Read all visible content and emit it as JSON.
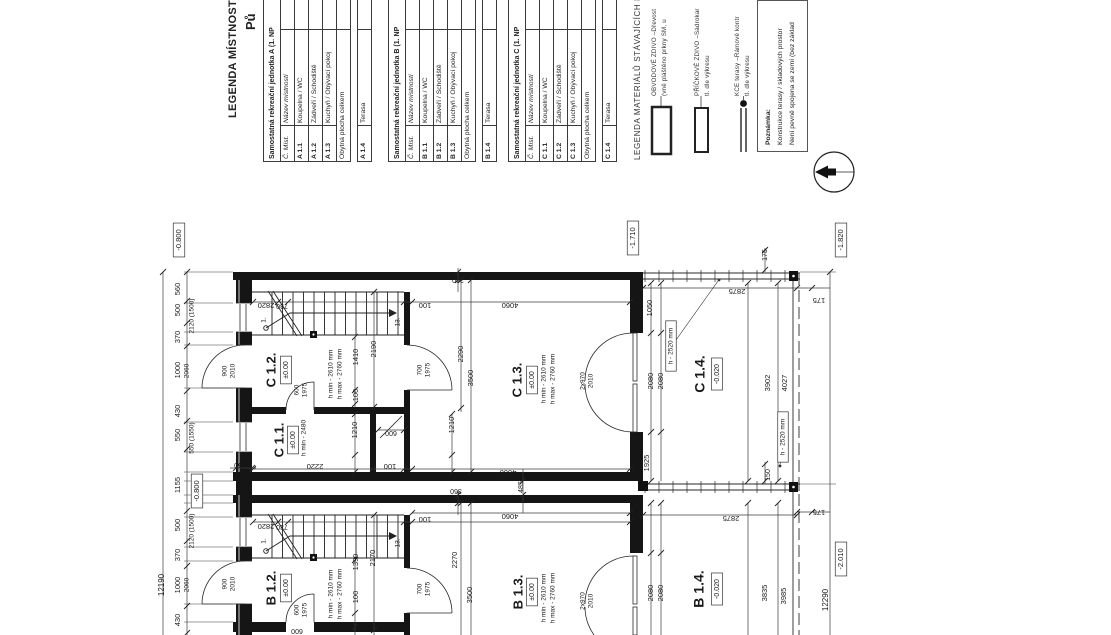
{
  "sheet": {
    "partial_title": "Pů",
    "rooms_legend_title": "LEGENDA MÍSTNOSTÍ:",
    "tables": [
      {
        "header": "Samostatná rekreační jednotka A (1. NP",
        "col1": "Č. Míst.",
        "col2": "Název místností",
        "rows": [
          [
            "A 1.1",
            "Koupelna / WC"
          ],
          [
            "A 1.2",
            "Zádveří / Schodiště"
          ],
          [
            "A 1.3",
            "Kuchyň / Obývací pokoj"
          ]
        ],
        "total_label": "Obytná plocha celkem",
        "extra_row": [
          "A 1.4",
          "Terasa"
        ]
      },
      {
        "header": "Samostatná rekreační jednotka B (1. NP",
        "col1": "Č. Míst.",
        "col2": "Název místností",
        "rows": [
          [
            "B 1.1",
            "Koupelna / WC"
          ],
          [
            "B 1.2",
            "Zádveří / Schodiště"
          ],
          [
            "B 1.3",
            "Kuchyň / Obývací pokoj"
          ]
        ],
        "total_label": "Obytná plocha celkem",
        "extra_row": [
          "B 1.4",
          "Terasa"
        ]
      },
      {
        "header": "Samostatná rekreační jednotka C (1. NP",
        "col1": "Č. Míst.",
        "col2": "Název místností",
        "rows": [
          [
            "C 1.1",
            "Koupelna / WC"
          ],
          [
            "C 1.2",
            "Zádveří / Schodiště"
          ],
          [
            "C 1.3",
            "Kuchyň / Obývací pokoj"
          ]
        ],
        "total_label": "Obytná plocha celkem",
        "extra_row": [
          "C 1.4",
          "Terasa"
        ]
      }
    ],
    "materials_legend": {
      "title": "LEGENDA MATERIÁLŮ STÁVAJÍCÍCH KONSTR",
      "items": [
        {
          "line1": "OBVODOVÉ ZDIVO –Dřevost",
          "line2": "(vně pláštěno prkny SM, u"
        },
        {
          "line1": "PŘÍČKOVÉ ZDIVO –Sádrokar",
          "line2": "tl. dle výkresu"
        },
        {
          "line1": "KCE terasy –Rámově kontr",
          "line2": "tl. dle výkresu"
        }
      ]
    },
    "note": {
      "title": "Poznámka:",
      "line1": "Konstrukce terasy / skladových prostor",
      "line2": "Není pevně spojena se zemí (bez základ"
    },
    "line_color": "#1a1a1a"
  },
  "plan": {
    "labels": [
      {
        "t": "-0.800",
        "x": 179,
        "y": 240,
        "r": -90,
        "s": 7.5,
        "box": 1
      },
      {
        "t": "-0.800",
        "x": 197,
        "y": 491,
        "r": -90,
        "s": 7.5,
        "box": 1
      },
      {
        "t": "-1.710",
        "x": 633,
        "y": 238,
        "r": -90,
        "s": 7.5,
        "box": 1
      },
      {
        "t": "-1.820",
        "x": 841,
        "y": 240,
        "r": -90,
        "s": 7.5,
        "box": 1
      },
      {
        "t": "-2.010",
        "x": 841,
        "y": 559,
        "r": -90,
        "s": 7.5,
        "box": 1
      },
      {
        "t": "±0.00",
        "x": 286,
        "y": 370,
        "r": -90,
        "s": 7,
        "box": 1
      },
      {
        "t": "±0.00",
        "x": 293,
        "y": 440,
        "r": -90,
        "s": 7,
        "box": 1
      },
      {
        "t": "±0.00",
        "x": 532,
        "y": 380,
        "r": -90,
        "s": 7,
        "box": 1
      },
      {
        "t": "±0.00",
        "x": 286,
        "y": 588,
        "r": -90,
        "s": 7,
        "box": 1
      },
      {
        "t": "±0.00",
        "x": 532,
        "y": 592,
        "r": -90,
        "s": 7,
        "box": 1
      },
      {
        "t": "-0.020",
        "x": 717,
        "y": 374,
        "r": -90,
        "s": 7,
        "box": 1
      },
      {
        "t": "-0.020",
        "x": 717,
        "y": 589,
        "r": -90,
        "s": 7,
        "box": 1
      },
      {
        "t": "h - 2520 mm",
        "x": 671,
        "y": 346,
        "r": -90,
        "s": 6.5,
        "box": 1
      },
      {
        "t": "h - 2520 mm",
        "x": 783,
        "y": 437,
        "r": -90,
        "s": 6.5,
        "box": 1
      },
      {
        "t": "C 1.2.",
        "x": 272,
        "y": 370,
        "r": -90,
        "s": 13,
        "b": 1
      },
      {
        "t": "C 1.1.",
        "x": 280,
        "y": 440,
        "r": -90,
        "s": 13,
        "b": 1
      },
      {
        "t": "C 1.3.",
        "x": 518,
        "y": 380,
        "r": -90,
        "s": 13,
        "b": 1
      },
      {
        "t": "C 1.4.",
        "x": 701,
        "y": 374,
        "r": -90,
        "s": 14,
        "b": 1
      },
      {
        "t": "B 1.2.",
        "x": 272,
        "y": 588,
        "r": -90,
        "s": 13,
        "b": 1
      },
      {
        "t": "B 1.3.",
        "x": 519,
        "y": 592,
        "r": -90,
        "s": 13,
        "b": 1
      },
      {
        "t": "B 1.4.",
        "x": 700,
        "y": 589,
        "r": -90,
        "s": 14,
        "b": 1
      },
      {
        "t": "h min - 2480",
        "x": 304,
        "y": 438,
        "r": -90,
        "s": 6.5
      },
      {
        "t": "h min - 2610 mm",
        "x": 331,
        "y": 374,
        "r": -90,
        "s": 6.5
      },
      {
        "t": "h max - 2760 mm",
        "x": 340,
        "y": 374,
        "r": -90,
        "s": 6.5
      },
      {
        "t": "h min - 2610 mm",
        "x": 544,
        "y": 379,
        "r": -90,
        "s": 6.5
      },
      {
        "t": "h max - 2760 mm",
        "x": 553,
        "y": 379,
        "r": -90,
        "s": 6.5
      },
      {
        "t": "h min - 2610 mm",
        "x": 331,
        "y": 594,
        "r": -90,
        "s": 6.5
      },
      {
        "t": "h max - 2760 mm",
        "x": 340,
        "y": 594,
        "r": -90,
        "s": 6.5
      },
      {
        "t": "h min - 2610 mm",
        "x": 544,
        "y": 598,
        "r": -90,
        "s": 6.5
      },
      {
        "t": "h max - 2760 mm",
        "x": 553,
        "y": 598,
        "r": -90,
        "s": 6.5
      },
      {
        "t": "2820",
        "x": 266,
        "y": 305,
        "r": 180,
        "s": 7.5
      },
      {
        "t": "730",
        "x": 282,
        "y": 306,
        "r": 180,
        "s": 7
      },
      {
        "t": "100",
        "x": 425,
        "y": 305,
        "r": 180,
        "s": 7.5
      },
      {
        "t": "4060",
        "x": 510,
        "y": 305,
        "r": 180,
        "s": 7.5
      },
      {
        "t": "360",
        "x": 458,
        "y": 280,
        "r": 180,
        "s": 7
      },
      {
        "t": "2220",
        "x": 315,
        "y": 466,
        "r": 180,
        "s": 7.5
      },
      {
        "t": "100",
        "x": 390,
        "y": 466,
        "r": 180,
        "s": 7.5
      },
      {
        "t": "360",
        "x": 240,
        "y": 465,
        "r": 180,
        "s": 7
      },
      {
        "t": "600",
        "x": 391,
        "y": 433,
        "r": 180,
        "s": 7
      },
      {
        "t": "4660",
        "x": 508,
        "y": 472,
        "r": 180,
        "s": 7.5
      },
      {
        "t": "4060",
        "x": 510,
        "y": 516,
        "r": 180,
        "s": 7.5
      },
      {
        "t": "2820",
        "x": 266,
        "y": 526,
        "r": 180,
        "s": 7.5
      },
      {
        "t": "730",
        "x": 282,
        "y": 527,
        "r": 180,
        "s": 7
      },
      {
        "t": "100",
        "x": 425,
        "y": 519,
        "r": 180,
        "s": 7.5
      },
      {
        "t": "360",
        "x": 456,
        "y": 491,
        "r": 180,
        "s": 7
      },
      {
        "t": "2875",
        "x": 737,
        "y": 291,
        "r": 180,
        "s": 7.5
      },
      {
        "t": "2875",
        "x": 731,
        "y": 518,
        "r": 180,
        "s": 7.5
      },
      {
        "t": "175",
        "x": 819,
        "y": 300,
        "r": 180,
        "s": 7.5
      },
      {
        "t": "175",
        "x": 819,
        "y": 512,
        "r": 180,
        "s": 7.5
      },
      {
        "t": "600",
        "x": 297,
        "y": 631,
        "r": 180,
        "s": 7
      },
      {
        "t": "560",
        "x": 178,
        "y": 289,
        "r": -90,
        "s": 7.5
      },
      {
        "t": "500",
        "x": 178,
        "y": 310,
        "r": -90,
        "s": 7.5
      },
      {
        "t": "370",
        "x": 178,
        "y": 337,
        "r": -90,
        "s": 7.5
      },
      {
        "t": "1000",
        "x": 178,
        "y": 370,
        "r": -90,
        "s": 7.5
      },
      {
        "t": "430",
        "x": 178,
        "y": 411,
        "r": -90,
        "s": 7.5
      },
      {
        "t": "550",
        "x": 178,
        "y": 435,
        "r": -90,
        "s": 7.5
      },
      {
        "t": "1155",
        "x": 178,
        "y": 485,
        "r": -90,
        "s": 7.5
      },
      {
        "t": "500",
        "x": 178,
        "y": 525,
        "r": -90,
        "s": 7.5
      },
      {
        "t": "370",
        "x": 178,
        "y": 555,
        "r": -90,
        "s": 7.5
      },
      {
        "t": "1000",
        "x": 178,
        "y": 585,
        "r": -90,
        "s": 7.5
      },
      {
        "t": "430",
        "x": 178,
        "y": 620,
        "r": -90,
        "s": 7.5
      },
      {
        "t": "12190",
        "x": 162,
        "y": 585,
        "r": -90,
        "s": 8
      },
      {
        "t": "12290",
        "x": 826,
        "y": 600,
        "r": -90,
        "s": 8
      },
      {
        "t": "2120 (1500)",
        "x": 192,
        "y": 316,
        "r": -90,
        "s": 6.5
      },
      {
        "t": "550 (1550)",
        "x": 192,
        "y": 438,
        "r": -90,
        "s": 6.5
      },
      {
        "t": "2120 (1500)",
        "x": 192,
        "y": 531,
        "r": -90,
        "s": 6.5
      },
      {
        "t": "2060",
        "x": 187,
        "y": 371,
        "r": -90,
        "s": 6.5
      },
      {
        "t": "2060",
        "x": 187,
        "y": 585,
        "r": -90,
        "s": 6.5
      },
      {
        "t": "2190",
        "x": 374,
        "y": 349,
        "r": -90,
        "s": 7.5
      },
      {
        "t": "1410",
        "x": 356,
        "y": 357,
        "r": -90,
        "s": 7.5
      },
      {
        "t": "100",
        "x": 356,
        "y": 395,
        "r": -90,
        "s": 7.5
      },
      {
        "t": "2290",
        "x": 461,
        "y": 354,
        "r": -90,
        "s": 7.5
      },
      {
        "t": "3500",
        "x": 471,
        "y": 378,
        "r": -90,
        "s": 7.5
      },
      {
        "t": "1210",
        "x": 355,
        "y": 430,
        "r": -90,
        "s": 7.5
      },
      {
        "t": "1210",
        "x": 452,
        "y": 425,
        "r": -90,
        "s": 7.5
      },
      {
        "t": "2170",
        "x": 373,
        "y": 558,
        "r": -90,
        "s": 7.5
      },
      {
        "t": "1390",
        "x": 356,
        "y": 562,
        "r": -90,
        "s": 7.5
      },
      {
        "t": "100",
        "x": 356,
        "y": 597,
        "r": -90,
        "s": 7.5
      },
      {
        "t": "2270",
        "x": 455,
        "y": 560,
        "r": -90,
        "s": 7.5
      },
      {
        "t": "3500",
        "x": 470,
        "y": 595,
        "r": -90,
        "s": 7.5
      },
      {
        "t": "1925",
        "x": 647,
        "y": 463,
        "r": -90,
        "s": 7.5
      },
      {
        "t": "1050",
        "x": 650,
        "y": 308,
        "r": -90,
        "s": 7.5
      },
      {
        "t": "2080",
        "x": 651,
        "y": 381,
        "r": -90,
        "s": 7.5
      },
      {
        "t": "2080",
        "x": 661,
        "y": 381,
        "r": -90,
        "s": 7.5
      },
      {
        "t": "2080",
        "x": 651,
        "y": 593,
        "r": -90,
        "s": 7.5
      },
      {
        "t": "2080",
        "x": 661,
        "y": 593,
        "r": -90,
        "s": 7.5
      },
      {
        "t": "3902",
        "x": 768,
        "y": 383,
        "r": -90,
        "s": 7.5
      },
      {
        "t": "4027",
        "x": 785,
        "y": 383,
        "r": -90,
        "s": 7.5
      },
      {
        "t": "3835",
        "x": 765,
        "y": 593,
        "r": -90,
        "s": 7.5
      },
      {
        "t": "3985",
        "x": 784,
        "y": 596,
        "r": -90,
        "s": 7.5
      },
      {
        "t": "485",
        "x": 521,
        "y": 487,
        "r": -90,
        "s": 7
      },
      {
        "t": "150",
        "x": 768,
        "y": 475,
        "r": -90,
        "s": 7
      },
      {
        "t": "175",
        "x": 765,
        "y": 255,
        "r": -90,
        "s": 7
      },
      {
        "t": "1.",
        "x": 264,
        "y": 320,
        "r": -90,
        "s": 6.5
      },
      {
        "t": "13.",
        "x": 398,
        "y": 322,
        "r": -90,
        "s": 6.5
      },
      {
        "t": "1.",
        "x": 264,
        "y": 541,
        "r": -90,
        "s": 6.5
      },
      {
        "t": "13.",
        "x": 398,
        "y": 543,
        "r": -90,
        "s": 6.5
      },
      {
        "t": "900",
        "x": 225,
        "y": 371,
        "r": -90,
        "s": 6.5
      },
      {
        "t": "2010",
        "x": 233,
        "y": 371,
        "r": -90,
        "s": 6.5
      },
      {
        "t": "900",
        "x": 225,
        "y": 584,
        "r": -90,
        "s": 6.5
      },
      {
        "t": "2010",
        "x": 233,
        "y": 584,
        "r": -90,
        "s": 6.5
      },
      {
        "t": "600",
        "x": 297,
        "y": 390,
        "r": -90,
        "s": 6.5
      },
      {
        "t": "1975",
        "x": 305,
        "y": 390,
        "r": -90,
        "s": 6.5
      },
      {
        "t": "600",
        "x": 297,
        "y": 610,
        "r": -90,
        "s": 6.5
      },
      {
        "t": "1975",
        "x": 305,
        "y": 610,
        "r": -90,
        "s": 6.5
      },
      {
        "t": "700",
        "x": 420,
        "y": 370,
        "r": -90,
        "s": 6.5
      },
      {
        "t": "1975",
        "x": 428,
        "y": 370,
        "r": -90,
        "s": 6.5
      },
      {
        "t": "700",
        "x": 420,
        "y": 589,
        "r": -90,
        "s": 6.5
      },
      {
        "t": "1975",
        "x": 428,
        "y": 589,
        "r": -90,
        "s": 6.5
      },
      {
        "t": "2x970",
        "x": 583,
        "y": 381,
        "r": -90,
        "s": 6.5
      },
      {
        "t": "2010",
        "x": 591,
        "y": 381,
        "r": -90,
        "s": 6.5
      },
      {
        "t": "2x970",
        "x": 583,
        "y": 601,
        "r": -90,
        "s": 6.5
      },
      {
        "t": "2010",
        "x": 591,
        "y": 601,
        "r": -90,
        "s": 6.5
      }
    ]
  }
}
